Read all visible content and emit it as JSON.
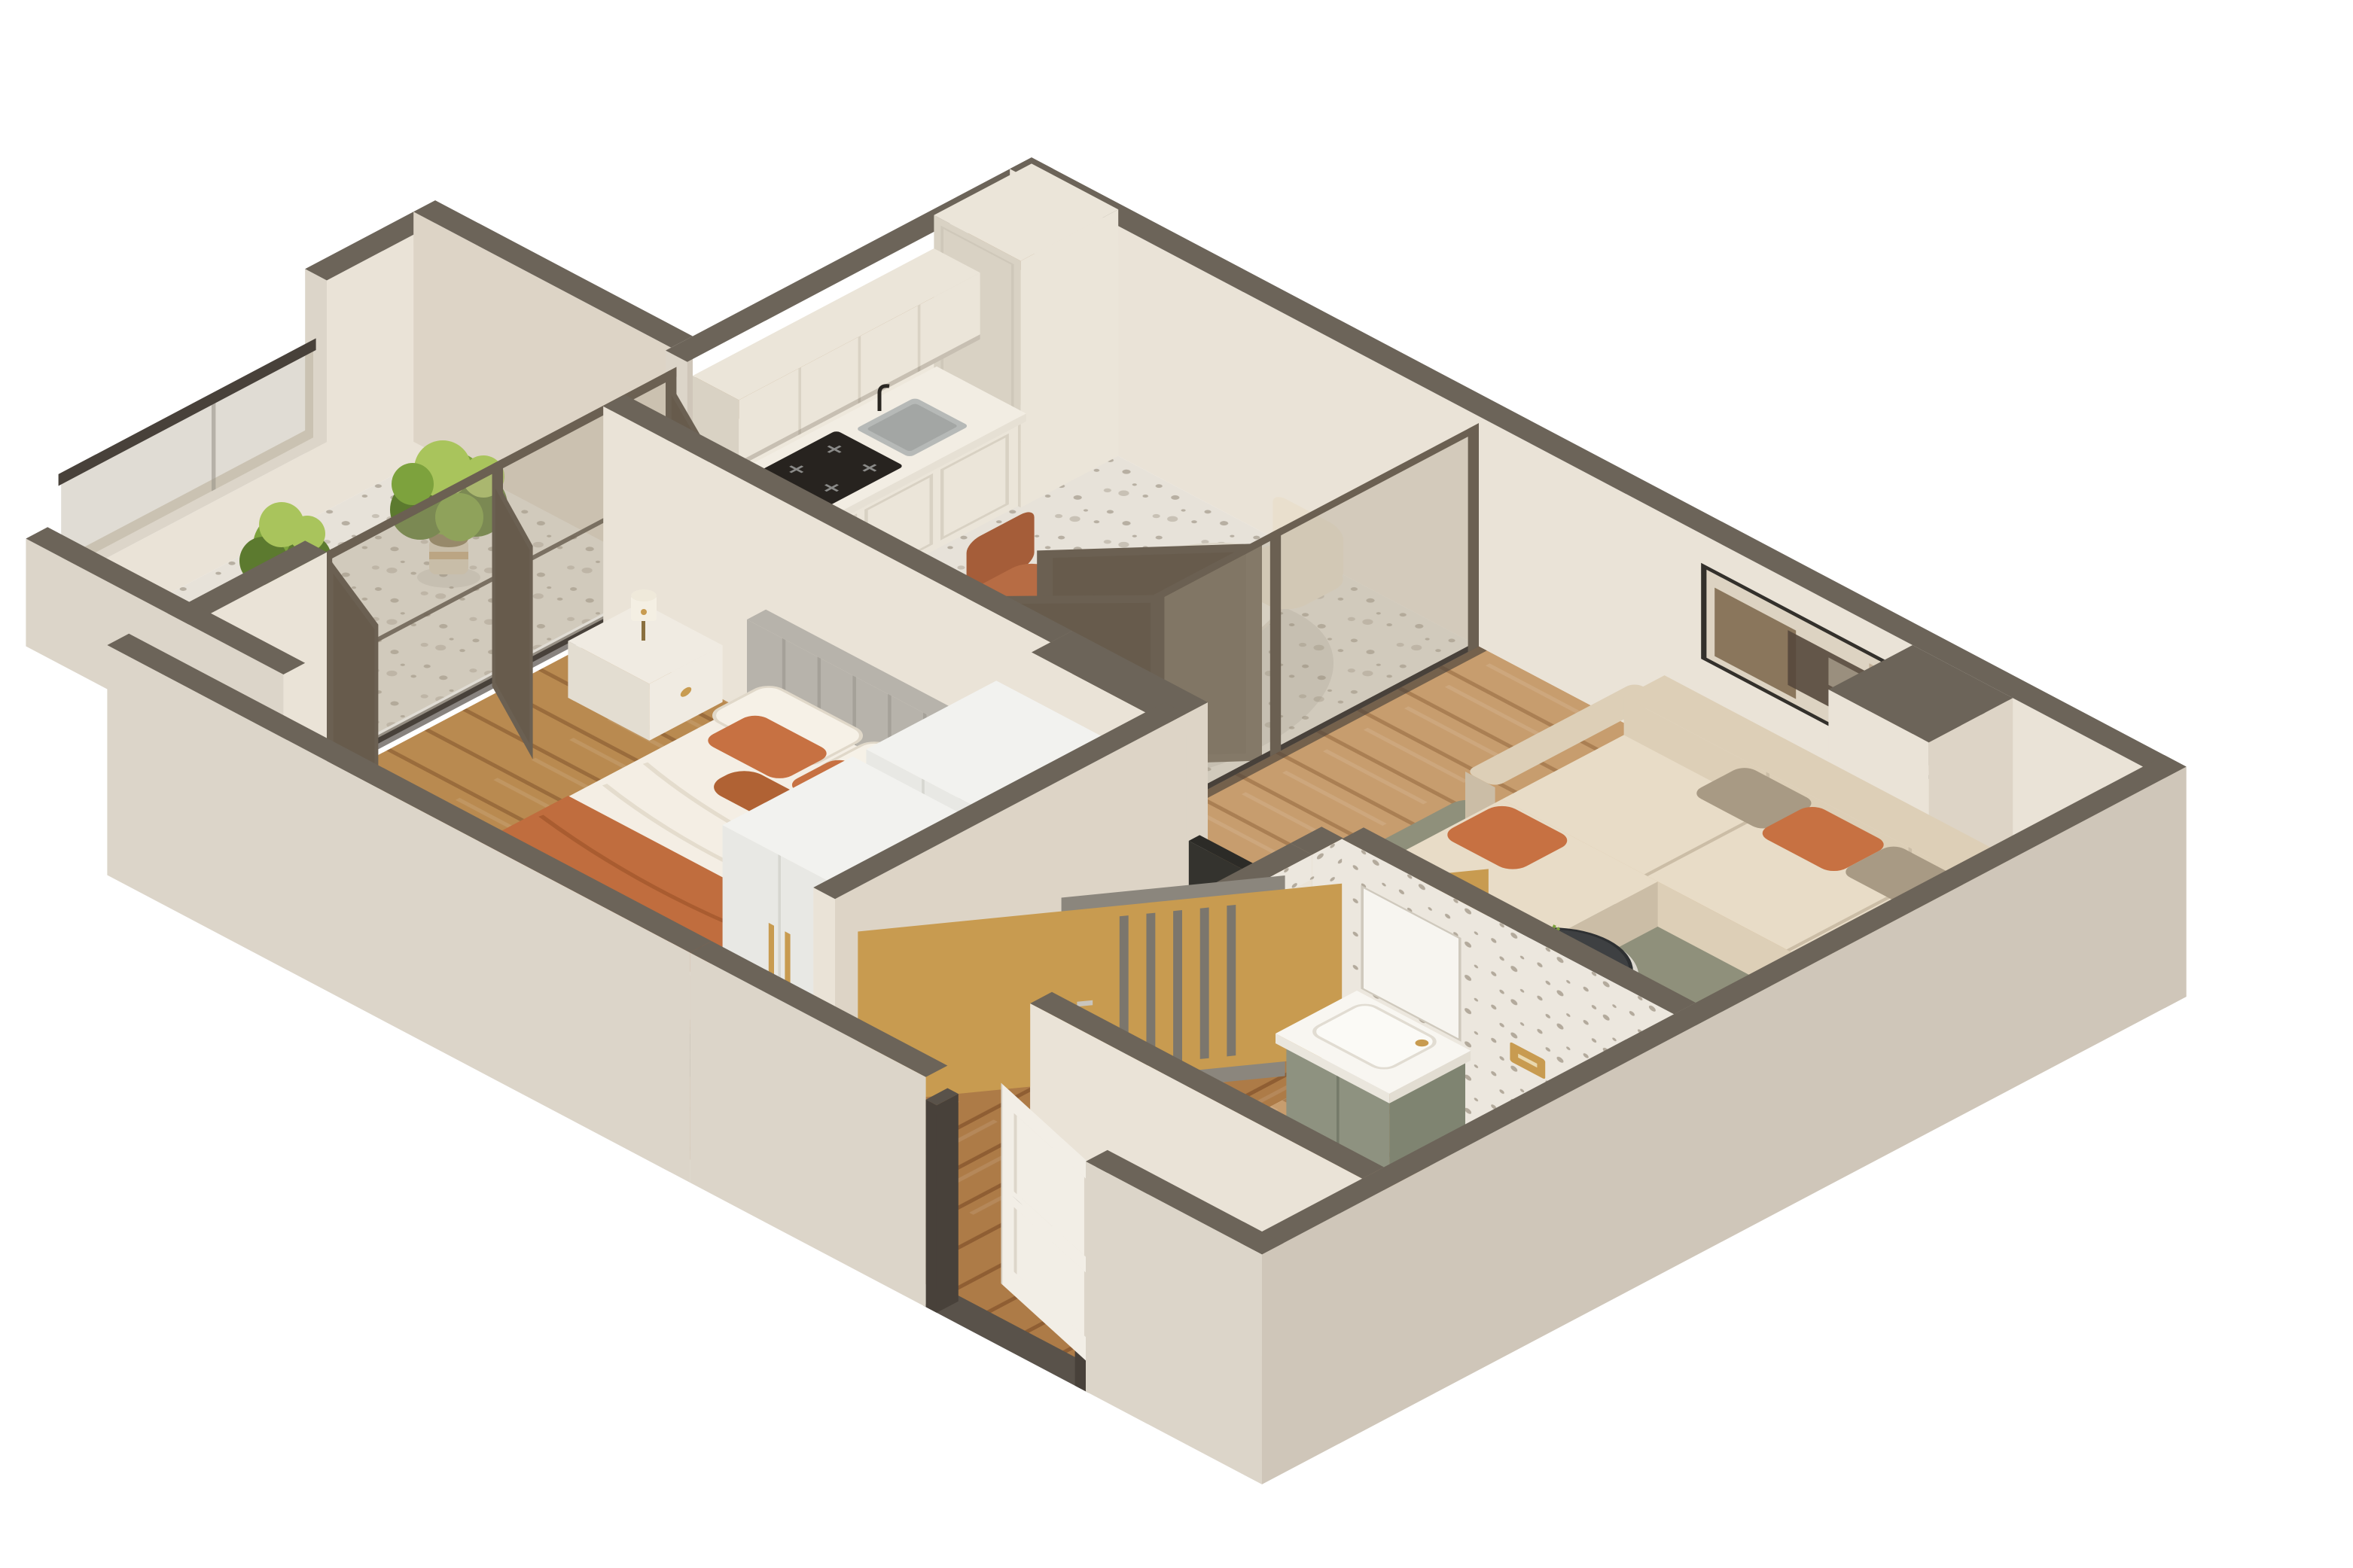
{
  "title": "3D isometric floor plan render of a one-bedroom apartment",
  "camera": "isometric dollhouse top-down, walls cut open, white background",
  "palette": {
    "wall-cap": "#6c6459",
    "wall-cap-dark": "#59524a",
    "ext-bright": "#dcd5c9",
    "ext-dark": "#cfc6b9",
    "int-face": "#eae3d7",
    "int-dark": "#ddd4c6",
    "terrazzo-bg": "#e7e2d9",
    "terrazzo-dot": "#b7afa2",
    "terrazzo-dot2": "#c8c1b5",
    "terrazzo-wall-bg": "#ece7de",
    "terrazzo-wall-dot": "#b3aa9c",
    "wood-living": "#c79d6e",
    "wood-living-line": "#aa7f53",
    "wood-bed": "#b98a50",
    "wood-bed-line": "#9a6c3c",
    "wood-hall": "#ad7b47",
    "wood-hall-line": "#8f5e33",
    "glass": "rgba(173,163,143,0.38)",
    "glass-dark": "rgba(98,86,68,0.42)",
    "frame-bronze": "#6b6052",
    "frame-dark": "#48413a",
    "cabinet": "#ebe5d9",
    "cabinet-shadow": "#d9d2c4",
    "counter-top": "#f2ede3",
    "marble-back": "#eee8dc",
    "wood-panel": "#a57b4b",
    "cooktop": "#27231f",
    "steel": "#b6b9b7",
    "sofa-base": "#ddcfb7",
    "sofa-seat": "#e8dcc7",
    "sofa-shadow": "#cbbda6",
    "pillow-orange": "#c77142",
    "pillow-orange-dark": "#b06234",
    "pillow-taupe": "#a89a84",
    "rug-living": "#8f907b",
    "rug-living-light": "#a6a590",
    "rug-runner": "#4b423a",
    "rug-runner-light": "#6a5c4e",
    "table-white": "#f1ece3",
    "table-top-dark": "#3e4042",
    "chair-terracotta": "#b76c44",
    "chair-terracotta-dark": "#a55d39",
    "chair-cream": "#e9dfcd",
    "art-frame": "#33302b",
    "art-canvas": "#ddd3c2",
    "duvet": "#f4eee4",
    "duvet-shadow": "#e3dbcc",
    "throw-orange": "#c06d3e",
    "headboard": "#b7b3ab",
    "headboard-dark": "#a5a199",
    "nightstand": "#f0ebe2",
    "lamp-cream": "#f4efe3",
    "gold": "#c89b50",
    "wardrobe-top": "#f2f2ef",
    "wardrobe-front": "#e8e8e4",
    "wardrobe-side": "#dfdfda",
    "door-gray": "#8b867d",
    "door-gray-dark": "#7b766d",
    "door-white": "#f2eee6",
    "vanity-green": "#8e9280",
    "vanity-green-dark": "#7f8471",
    "porcelain": "#f8f6f1",
    "tub-inner": "#efece5",
    "plant-dark": "#5c7a2f",
    "plant-mid": "#7da23d",
    "plant-light": "#a9c45c",
    "pot-tan": "#c3a77d",
    "pot-cream": "#d8cdb9",
    "tv-dark": "#34332e",
    "shadow": "rgba(70,60,45,0.10)"
  },
  "scene": {
    "rooms": [
      {
        "name": "kitchen-dining",
        "floor": "terrazzo",
        "items": [
          "tall cabinet",
          "upper cabinets",
          "base cabinets",
          "marble counter",
          "wood backsplash",
          "steel sink",
          "black faucet",
          "induction cooktop",
          "oval dining table",
          "cream chair",
          "terracotta chair",
          "terracotta chair"
        ]
      },
      {
        "name": "living-room",
        "floor": "light wood",
        "items": [
          "L-shaped beige sectional sofa",
          "orange pillows x3",
          "taupe pillows x3",
          "abstract wall art",
          "sage rug",
          "round drum coffee table",
          "potted plant",
          "TV panel"
        ]
      },
      {
        "name": "bedroom",
        "floor": "wood",
        "items": [
          "double bed",
          "channel-tufted gray headboard",
          "white pillows",
          "orange pillows",
          "orange throw",
          "nightstand",
          "table lamp",
          "dark runner rug",
          "TV panel",
          "wardrobe x2 with gold pulls"
        ]
      },
      {
        "name": "bathroom",
        "floor": "wood",
        "walls": "terrazzo",
        "items": [
          "green vanity",
          "white counter basin",
          "mirror",
          "wall-hung toilet",
          "gold flush plate",
          "bathtub",
          "toilet brush",
          "paper holder",
          "gray door with gold trim"
        ]
      },
      {
        "name": "balcony",
        "floor": "terrazzo",
        "items": [
          "fern plant",
          "bushy plant",
          "glass railing",
          "sliding glass doors"
        ]
      },
      {
        "name": "hallway",
        "floor": "wood",
        "items": [
          "white entrance door"
        ]
      }
    ]
  }
}
